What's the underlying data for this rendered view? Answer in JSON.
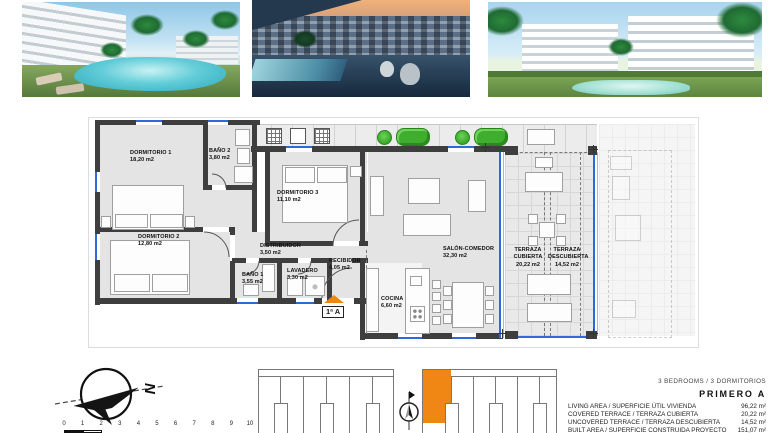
{
  "photos": [
    {
      "name": "pool-garden-day-render"
    },
    {
      "name": "terrace-dusk-render"
    },
    {
      "name": "buildings-pool-day-render"
    }
  ],
  "plan": {
    "unit_tag": "1ª A",
    "rooms": {
      "dormitorio1": {
        "name": "DORMITORIO 1",
        "area": "18,20 m2"
      },
      "bano2": {
        "name": "BAÑO 2",
        "area": "3,80 m2"
      },
      "dormitorio3": {
        "name": "DORMITORIO 3",
        "area": "11,10 m2"
      },
      "dormitorio2": {
        "name": "DORMITORIO 2",
        "area": "12,80 m2"
      },
      "distribuidor": {
        "name": "DISTRIBUIDOR",
        "area": "3,50 m2"
      },
      "bano1": {
        "name": "BAÑO 1",
        "area": "3,55 m2"
      },
      "lavadero": {
        "name": "LAVADERO",
        "area": "3,30 m2"
      },
      "recibidor": {
        "name": "RECIBIDOR",
        "area": "4,05 m2"
      },
      "salon": {
        "name": "SALÓN-COMEDOR",
        "area": "32,30 m2"
      },
      "cocina": {
        "name": "COCINA",
        "area": "6,60 m2"
      },
      "terraza_cubierta": {
        "line1": "TERRAZA",
        "line2": "CUBIERTA",
        "area": "20,22 m2"
      },
      "terraza_descubierta": {
        "line1": "TERRAZA",
        "line2": "DESCUBIERTA",
        "area": "14,52 m2"
      }
    }
  },
  "compass": {
    "letter": "N"
  },
  "scale": {
    "numbers": [
      "0",
      "1",
      "2",
      "3",
      "4",
      "5",
      "6",
      "7",
      "8",
      "9",
      "10"
    ]
  },
  "summary": {
    "bedrooms": "3 BEDROOMS / 3 DORMITORIOS",
    "unit": "PRIMERO A",
    "rows": [
      {
        "label": "LIVING AREA / SUPERFICIE ÚTIL VIVIENDA",
        "value": "96,22 m²"
      },
      {
        "label": "COVERED TERRACE / TERRAZA CUBIERTA",
        "value": "20,22 m²"
      },
      {
        "label": "UNCOVERED TERRACE / TERRAZA DESCUBIERTA",
        "value": "14,52 m²"
      },
      {
        "label": "BUILT AREA / SUPERFICIE CONSTRUIDA PROYECTO",
        "value": "151,07 m²"
      }
    ]
  },
  "colors": {
    "accent_orange": "#F08613",
    "window_blue": "#2E68D9",
    "plant_green": "#3FAE2E",
    "wall_gray": "#3E3E3E"
  }
}
